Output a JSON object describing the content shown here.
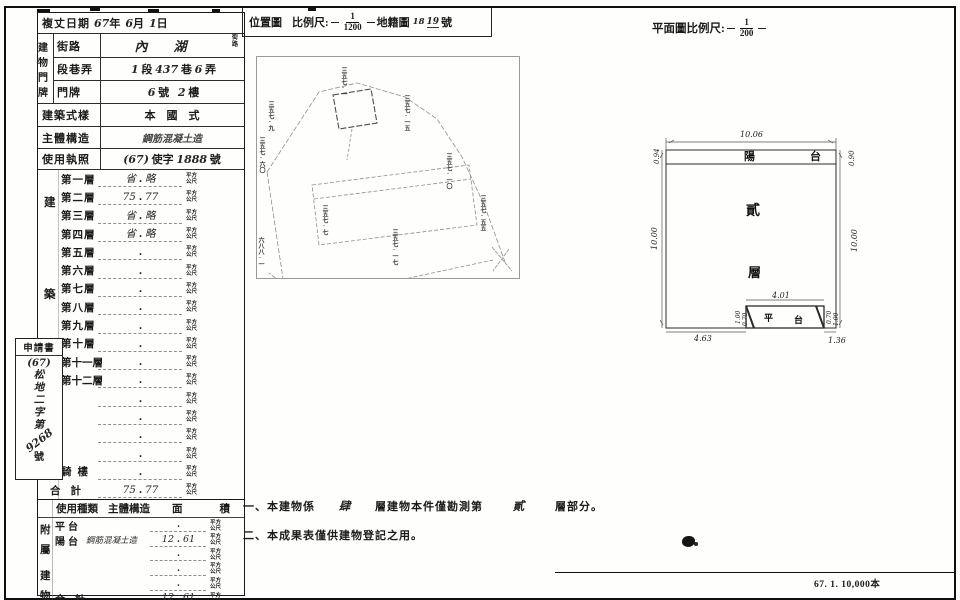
{
  "sheet": {
    "dot": ".",
    "imprint": "67. 1. 10,000本"
  },
  "survey": {
    "label": "複丈日期",
    "year": "67",
    "y_unit": "年",
    "month": "6",
    "m_unit": "月",
    "day": "1",
    "d_unit": "日"
  },
  "address": {
    "group": "建物門牌",
    "street_label": "街路",
    "street_value": "內湖",
    "street_suffix": "街路",
    "section_label": "段巷弄",
    "sec_v1": "1",
    "sec_u1": "段",
    "sec_v2": "437",
    "sec_u2": "巷",
    "sec_v3": "6",
    "sec_u3": "弄",
    "door_label": "門牌",
    "door_v1": "6",
    "door_u1": "號",
    "door_v2": "2",
    "door_u2": "樓"
  },
  "style_row": {
    "label": "建築式樣",
    "value": "本　國　式"
  },
  "structure_row": {
    "label": "主體構造",
    "value": "鋼筋混凝土造"
  },
  "license_row": {
    "label": "使用執照",
    "p1": "(67)",
    "p2": "使字",
    "p3": "1888",
    "p4": "號"
  },
  "area_table": {
    "group_chars": [
      "建",
      "築",
      "面",
      "積"
    ],
    "unit": "平方公尺",
    "floors": [
      {
        "label": "第一層",
        "left": "省",
        "right": "略"
      },
      {
        "label": "第二層",
        "left": "75",
        "right": "77"
      },
      {
        "label": "第三層",
        "left": "省",
        "right": "略"
      },
      {
        "label": "第四層",
        "left": "省",
        "right": "略"
      },
      {
        "label": "第五層",
        "left": "",
        "right": ""
      },
      {
        "label": "第六層",
        "left": "",
        "right": ""
      },
      {
        "label": "第七層",
        "left": "",
        "right": ""
      },
      {
        "label": "第八層",
        "left": "",
        "right": ""
      },
      {
        "label": "第九層",
        "left": "",
        "right": ""
      },
      {
        "label": "第十層",
        "left": "",
        "right": ""
      },
      {
        "label": "第十一層",
        "left": "",
        "right": ""
      },
      {
        "label": "第十二層",
        "left": "",
        "right": ""
      },
      {
        "label": "",
        "left": "",
        "right": ""
      },
      {
        "label": "",
        "left": "",
        "right": ""
      },
      {
        "label": "",
        "left": "",
        "right": ""
      },
      {
        "label": "",
        "left": "",
        "right": ""
      },
      {
        "label": "騎樓",
        "left": "",
        "right": ""
      },
      {
        "label": "合計",
        "left": "75",
        "right": "77"
      }
    ]
  },
  "applicant": {
    "title": "申請書",
    "paren": "(67)",
    "office": "松地二字第",
    "number": "9268",
    "suffix": "號"
  },
  "attached_table": {
    "group_chars": [
      "附",
      "屬",
      "建",
      "物"
    ],
    "header": {
      "use": "使用種類",
      "structure": "主體構造",
      "area_l": "面",
      "area_r": "積"
    },
    "unit": "平方公尺",
    "rows": [
      {
        "label": "平台",
        "structure": "",
        "left": "",
        "right": ""
      },
      {
        "label": "陽台",
        "structure": "鋼筋混凝土造",
        "left": "12",
        "right": "61"
      },
      {
        "label": "",
        "structure": "",
        "left": "",
        "right": ""
      },
      {
        "label": "",
        "structure": "",
        "left": "",
        "right": ""
      },
      {
        "label": "",
        "structure": "",
        "left": "",
        "right": ""
      },
      {
        "label": "合計",
        "structure": "",
        "left": "12",
        "right": "61"
      }
    ]
  },
  "location_map": {
    "title": "位置圖",
    "scale_label": "比例尺:",
    "scale_num": "1",
    "scale_den": "1200",
    "cadastral_label": "地籍圖",
    "sheet_sup": "18",
    "sheet_no": "19",
    "sheet_unit": "號",
    "lots": [
      "三五七-一",
      "三五七-一五",
      "三五七-九",
      "三五七-六〇",
      "六八八-一",
      "三五七-一七",
      "三五七-五五",
      "三五七-一〇",
      "三五七-七"
    ]
  },
  "floor_plan": {
    "title": "平面圖比例尺:",
    "scale_num": "1",
    "scale_den": "200",
    "balcony": "陽　台",
    "floor_char1": "貳",
    "floor_char2": "層",
    "platform_1": "平",
    "platform_2": "台",
    "dims": {
      "top": "10.06",
      "left_top": "0.94",
      "right_top": "0.90",
      "left": "10.00",
      "right": "10.00",
      "platform_top": "4.01",
      "bottom_left": "4.63",
      "bottom_right": "1.36",
      "p_l1": "1.00",
      "p_l2": "0.70",
      "p_r1": "0.70",
      "p_r2": "1.00"
    }
  },
  "notes": {
    "n1_pre": "一、本建物係",
    "n1_hand1": "肆",
    "n1_mid": "層建物本件僅勘測第",
    "n1_hand2": "貳",
    "n1_post": "層部分。",
    "n2": "二、本成果表僅供建物登記之用。"
  }
}
